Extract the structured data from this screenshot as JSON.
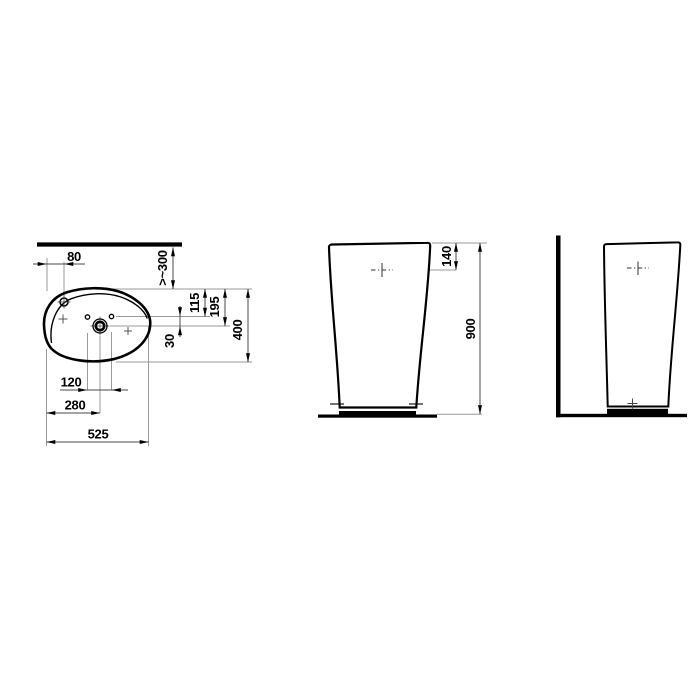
{
  "drawing": {
    "type": "sanitaryware technical dimension drawing",
    "background": "#ffffff",
    "colors": {
      "outline": "#000000",
      "dimension_line": "#4a4a4a",
      "extension_line": "#9a9a9a",
      "label_text": "#000000"
    },
    "plan": {
      "dims": {
        "tap_hole_offset": "80",
        "min_wall_distance": ">~300",
        "holes_from_front": "115",
        "drain_from_front": "195",
        "holes_to_drain": "30",
        "basin_depth": "400",
        "side_holes_spacing": "120",
        "drain_from_left": "280",
        "basin_width": "525"
      }
    },
    "front": {
      "dims": {
        "tap_below_rim": "140",
        "total_height": "900"
      }
    }
  }
}
